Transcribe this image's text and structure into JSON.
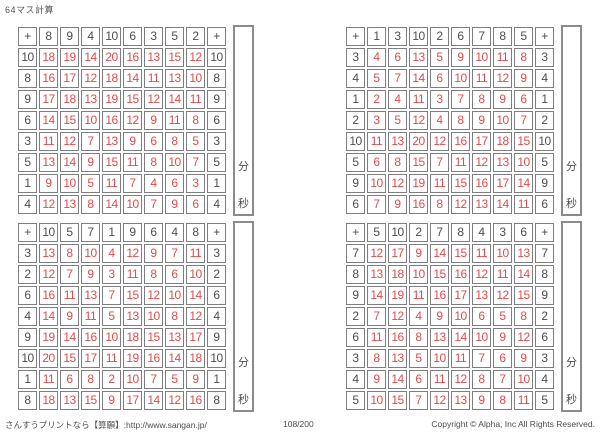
{
  "page": {
    "title": "64マス計算"
  },
  "colors": {
    "answer_red": "#e04b4b",
    "printed_gray": "#4d4d4d",
    "border_gray": "#7e7e7e"
  },
  "timer": {
    "minutes_label": "分",
    "seconds_label": "秒"
  },
  "footer": {
    "site": "さんすうプリントなら【算願】:http://www.sangan.jp/",
    "page_number": "108/200",
    "copyright": "Copyright © Alpha, Inc All Rights Reserved."
  },
  "grids": [
    {
      "operator": "+",
      "top_headers": [
        8,
        9,
        4,
        10,
        6,
        3,
        5,
        2
      ],
      "rows": [
        {
          "left": 10,
          "answers": [
            18,
            19,
            14,
            20,
            16,
            13,
            15,
            12
          ]
        },
        {
          "left": 8,
          "answers": [
            16,
            17,
            12,
            18,
            14,
            11,
            13,
            10
          ]
        },
        {
          "left": 9,
          "answers": [
            17,
            18,
            13,
            19,
            15,
            12,
            14,
            11
          ]
        },
        {
          "left": 6,
          "answers": [
            14,
            15,
            10,
            16,
            12,
            9,
            11,
            8
          ]
        },
        {
          "left": 3,
          "answers": [
            11,
            12,
            7,
            13,
            9,
            6,
            8,
            5
          ]
        },
        {
          "left": 5,
          "answers": [
            13,
            14,
            9,
            15,
            11,
            8,
            10,
            7
          ]
        },
        {
          "left": 1,
          "answers": [
            9,
            10,
            5,
            11,
            7,
            4,
            6,
            3
          ]
        },
        {
          "left": 4,
          "answers": [
            12,
            13,
            8,
            14,
            10,
            7,
            9,
            6
          ]
        }
      ]
    },
    {
      "operator": "+",
      "top_headers": [
        1,
        3,
        10,
        2,
        6,
        7,
        8,
        5
      ],
      "rows": [
        {
          "left": 3,
          "answers": [
            4,
            6,
            13,
            5,
            9,
            10,
            11,
            8
          ]
        },
        {
          "left": 4,
          "answers": [
            5,
            7,
            14,
            6,
            10,
            11,
            12,
            9
          ]
        },
        {
          "left": 1,
          "answers": [
            2,
            4,
            11,
            3,
            7,
            8,
            9,
            6
          ]
        },
        {
          "left": 2,
          "answers": [
            3,
            5,
            12,
            4,
            8,
            9,
            10,
            7
          ]
        },
        {
          "left": 10,
          "answers": [
            11,
            13,
            20,
            12,
            16,
            17,
            18,
            15
          ]
        },
        {
          "left": 5,
          "answers": [
            6,
            8,
            15,
            7,
            11,
            12,
            13,
            10
          ]
        },
        {
          "left": 9,
          "answers": [
            10,
            12,
            19,
            11,
            15,
            16,
            17,
            14
          ]
        },
        {
          "left": 6,
          "answers": [
            7,
            9,
            16,
            8,
            12,
            13,
            14,
            11
          ]
        }
      ]
    },
    {
      "operator": "+",
      "top_headers": [
        10,
        5,
        7,
        1,
        9,
        6,
        4,
        8
      ],
      "rows": [
        {
          "left": 3,
          "answers": [
            13,
            8,
            10,
            4,
            12,
            9,
            7,
            11
          ]
        },
        {
          "left": 2,
          "answers": [
            12,
            7,
            9,
            3,
            11,
            8,
            6,
            10
          ]
        },
        {
          "left": 6,
          "answers": [
            16,
            11,
            13,
            7,
            15,
            12,
            10,
            14
          ]
        },
        {
          "left": 4,
          "answers": [
            14,
            9,
            11,
            5,
            13,
            10,
            8,
            12
          ]
        },
        {
          "left": 9,
          "answers": [
            19,
            14,
            16,
            10,
            18,
            15,
            13,
            17
          ]
        },
        {
          "left": 10,
          "answers": [
            20,
            15,
            17,
            11,
            19,
            16,
            14,
            18
          ]
        },
        {
          "left": 1,
          "answers": [
            11,
            6,
            8,
            2,
            10,
            7,
            5,
            9
          ]
        },
        {
          "left": 8,
          "answers": [
            18,
            13,
            15,
            9,
            17,
            14,
            12,
            16
          ]
        }
      ]
    },
    {
      "operator": "+",
      "top_headers": [
        5,
        10,
        2,
        7,
        8,
        4,
        3,
        6
      ],
      "rows": [
        {
          "left": 7,
          "answers": [
            12,
            17,
            9,
            14,
            15,
            11,
            10,
            13
          ]
        },
        {
          "left": 8,
          "answers": [
            13,
            18,
            10,
            15,
            16,
            12,
            11,
            14
          ]
        },
        {
          "left": 9,
          "answers": [
            14,
            19,
            11,
            16,
            17,
            13,
            12,
            15
          ]
        },
        {
          "left": 2,
          "answers": [
            7,
            12,
            4,
            9,
            10,
            6,
            5,
            8
          ]
        },
        {
          "left": 6,
          "answers": [
            11,
            16,
            8,
            13,
            14,
            10,
            9,
            12
          ]
        },
        {
          "left": 3,
          "answers": [
            8,
            13,
            5,
            10,
            11,
            7,
            6,
            9
          ]
        },
        {
          "left": 4,
          "answers": [
            9,
            14,
            6,
            11,
            12,
            8,
            7,
            10
          ]
        },
        {
          "left": 5,
          "answers": [
            10,
            15,
            7,
            12,
            13,
            9,
            8,
            11
          ]
        }
      ]
    }
  ]
}
